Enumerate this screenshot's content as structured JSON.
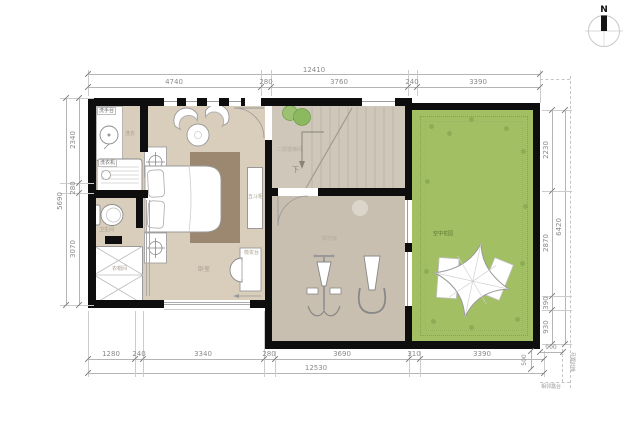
{
  "north": {
    "label": "N"
  },
  "dimensions": {
    "top": {
      "total": "12410",
      "segments": [
        "4740",
        "280",
        "3760",
        "240",
        "3390"
      ]
    },
    "bottom": {
      "total": "12530",
      "segments": [
        "1280",
        "240",
        "3340",
        "280",
        "3690",
        "310",
        "3390"
      ]
    },
    "left": {
      "total": "5690",
      "segments": [
        "2340",
        "280",
        "3070"
      ]
    },
    "right": {
      "total": "6420",
      "segments": [
        "2230",
        "2870",
        "390",
        "930"
      ]
    },
    "corner": {
      "width": "900",
      "height": "500",
      "side_label": "相邻露台",
      "bottom_label": "相邻露台"
    }
  },
  "rooms": {
    "laundry": {
      "label": "洗衣",
      "sink_tag": "洗手台",
      "washer_tag": "洗衣机"
    },
    "bathroom": {
      "label": "卫生间"
    },
    "closet": {
      "label": "衣帽间"
    },
    "bedroom": {
      "label": "卧室",
      "cabinet": "五斗柜",
      "dresser": "梳妆台"
    },
    "stairwell": {
      "label": "二层楼梯间",
      "down": "下"
    },
    "sunroom": {
      "label": "阳光房"
    },
    "garden": {
      "label": "空中花园"
    }
  },
  "colors": {
    "wall": "#0e0e0e",
    "floor": "#d9cdbb",
    "stair_floor": "#cfc8ba",
    "sunroom_floor": "#c9bfb0",
    "garden": "#a2c063",
    "rug": "#9c8870",
    "dim_text": "#8a8a8a",
    "garden_border": "#7ea14c"
  }
}
